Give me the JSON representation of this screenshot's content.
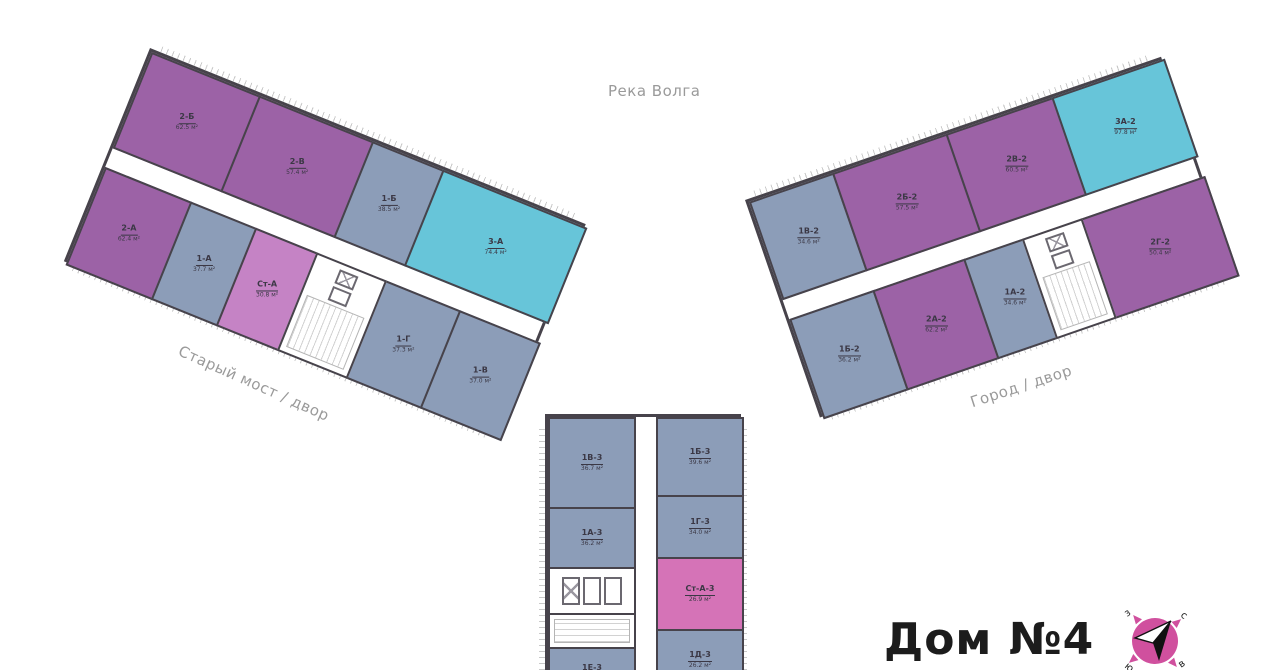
{
  "title": {
    "house": "Дом №4"
  },
  "area_labels": {
    "river": "Река Волга",
    "southwest": "Старый мост / двор",
    "southeast": "Город / двор"
  },
  "colors": {
    "one_room": "#8C9DB8",
    "two_room": "#9C62A6",
    "three_room": "#67C5D9",
    "studio": "#C583C5",
    "studio_alt": "#D573B7",
    "wall": "#47434B",
    "label_text": "#3B3845",
    "muted_text": "#9A9A9A",
    "title_text": "#1C1C1C",
    "compass": "#D0509E"
  },
  "wings": {
    "left": {
      "apartments": [
        {
          "id": "2-Б",
          "area": "62.5 м²",
          "type": "two_room"
        },
        {
          "id": "2-В",
          "area": "57.4 м²",
          "type": "two_room"
        },
        {
          "id": "1-Б",
          "area": "38.5 м²",
          "type": "one_room"
        },
        {
          "id": "3-А",
          "area": "74.4 м²",
          "type": "three_room"
        },
        {
          "id": "2-А",
          "area": "62.4 м²",
          "type": "two_room"
        },
        {
          "id": "1-А",
          "area": "37.7 м²",
          "type": "one_room"
        },
        {
          "id": "Ст-А",
          "area": "30.8 м²",
          "type": "studio"
        },
        {
          "id": "1-Г",
          "area": "37.3 м²",
          "type": "one_room"
        },
        {
          "id": "1-В",
          "area": "37.0 м²",
          "type": "one_room"
        }
      ]
    },
    "right": {
      "apartments": [
        {
          "id": "1В-2",
          "area": "34.6 м²",
          "type": "one_room"
        },
        {
          "id": "2Б-2",
          "area": "57.5 м²",
          "type": "two_room"
        },
        {
          "id": "2В-2",
          "area": "60.5 м²",
          "type": "two_room"
        },
        {
          "id": "3А-2",
          "area": "97.8 м²",
          "type": "three_room"
        },
        {
          "id": "1Б-2",
          "area": "36.2 м²",
          "type": "one_room"
        },
        {
          "id": "2А-2",
          "area": "62.2 м²",
          "type": "two_room"
        },
        {
          "id": "1А-2",
          "area": "34.6 м²",
          "type": "one_room"
        },
        {
          "id": "2Г-2",
          "area": "50.4 м²",
          "type": "two_room"
        }
      ]
    },
    "bottom": {
      "apartments": [
        {
          "id": "1В-3",
          "area": "36.7 м²",
          "type": "one_room"
        },
        {
          "id": "1Б-3",
          "area": "39.6 м²",
          "type": "one_room"
        },
        {
          "id": "1А-3",
          "area": "36.2 м²",
          "type": "one_room"
        },
        {
          "id": "1Г-3",
          "area": "34.0 м²",
          "type": "one_room"
        },
        {
          "id": "Ст-А-3",
          "area": "26.9 м²",
          "type": "studio_alt"
        },
        {
          "id": "1Д-3",
          "area": "26.2 м²",
          "type": "one_room"
        },
        {
          "id": "1Е-3",
          "area": "",
          "type": "one_room"
        }
      ]
    }
  },
  "compass": {
    "north": "с",
    "south": "ю",
    "west": "з",
    "east": "в"
  }
}
